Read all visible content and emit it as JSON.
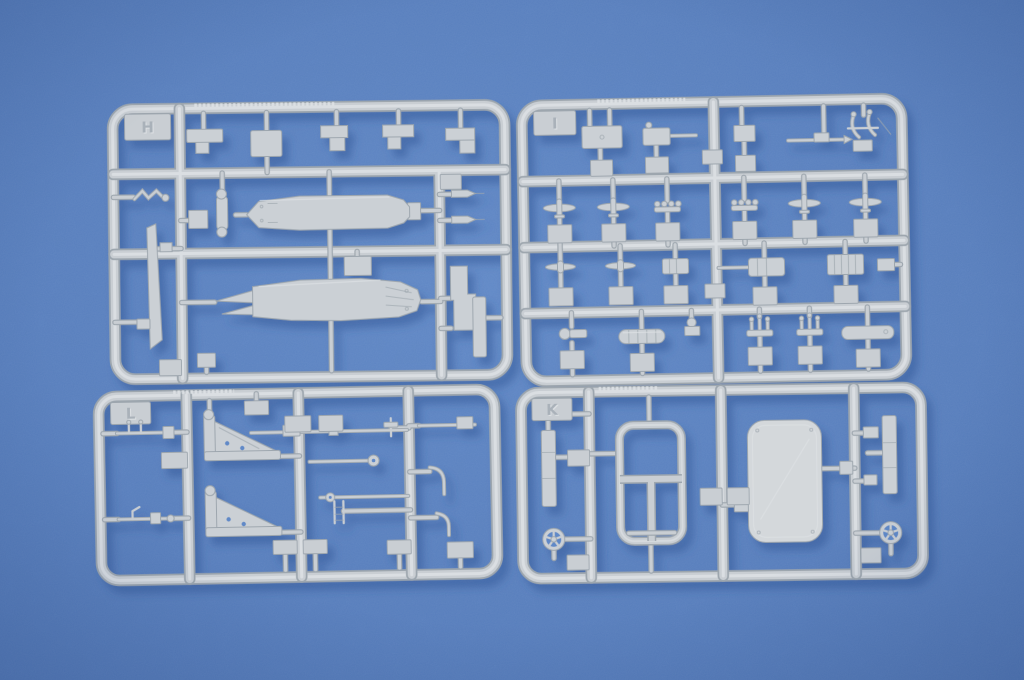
{
  "scene": {
    "subject": "four light-gray injection-molded model kit sprues photographed on blue textured paper",
    "sprues": [
      {
        "letter": "H",
        "position": "top-left"
      },
      {
        "letter": "I",
        "position": "top-right"
      },
      {
        "letter": "L",
        "position": "bottom-left"
      },
      {
        "letter": "K",
        "position": "bottom-right"
      }
    ]
  },
  "colors": {
    "bg": "#6189c7",
    "bgEdge": "#5278b7",
    "vignette": "#1d3a70",
    "plastic": "#c9ced3",
    "plasticHi": "#dde1e4",
    "plasticShade": "#9da6ae",
    "part": "#cbd0d5",
    "panel": "#d4d8db",
    "emboss": "#a9b1b9",
    "shadow": "#2f5596"
  }
}
